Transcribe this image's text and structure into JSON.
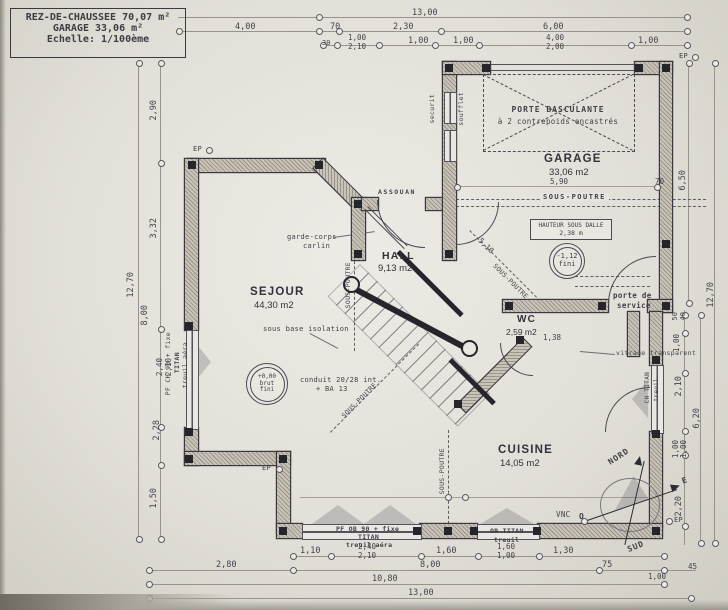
{
  "legend": {
    "title": "REZ-DE-CHAUSSEE  70,07 m²",
    "garage": "GARAGE  33,06 m²",
    "scale": "Echelle: 1/100ème"
  },
  "rooms": {
    "sejour": {
      "name": "SEJOUR",
      "area": "44,30 m2"
    },
    "hall": {
      "name": "HALL",
      "area": "9,13 m2"
    },
    "garage": {
      "name": "GARAGE",
      "area": "33,06 m2"
    },
    "wc": {
      "name": "WC",
      "area": "2,59 m2"
    },
    "cuisine": {
      "name": "CUISINE",
      "area": "14,05 m2"
    }
  },
  "annotations": {
    "porte_basculante_l1": "PORTE BASCULANTE",
    "porte_basculante_l2": "à 2 contrepoids encastrés",
    "sous_poutre": "SOUS-POUTRE",
    "hauteur_dalle_l1": "HAUTEUR SOUS DALLE",
    "hauteur_dalle_l2": "2,38 m",
    "level_low_l1": "-1,12",
    "level_low_l2": "fini",
    "level_zero_l1": "+0,00",
    "level_zero_l2": "brut",
    "level_zero_l3": "+0,12",
    "level_zero_l4": "fini",
    "garde_corps_l1": "garde-corps",
    "garde_corps_l2": "carlin",
    "porte_service_l1": "porte de",
    "porte_service_l2": "service",
    "vitrage": "vitrage transparent",
    "vnc": "VNC",
    "ep": "EP",
    "assouan": "ASSOUAN",
    "securit": "securit",
    "soufflet": "soufflet",
    "isolation": "sous base isolation",
    "conduit_l1": "conduit 20/28 int.",
    "conduit_l2": "+ BA 13"
  },
  "windows": {
    "left_l1": "PF CH 90 + fixe",
    "left_l2": "TITAN",
    "left_l3": "treuil aéra",
    "bottom_l1": "PF OB 90 + fixe",
    "bottom_l2": "TITAN",
    "bottom_l3": "treuil aéra",
    "bottom2_l1": "OB TITAN",
    "bottom2_l2": "treuil",
    "right_l1": "CH TITAN",
    "right_l2": "treuil"
  },
  "compass": {
    "north": "NORD",
    "south": "SUD",
    "east": "E",
    "west": "O"
  },
  "dims": {
    "top": [
      "13,00",
      "4,00",
      "70",
      "2,30",
      "6,00",
      "30",
      "1,00",
      "2,10",
      "1,00",
      "1,00",
      "4,00",
      "2,00",
      "1,00"
    ],
    "bottom": [
      "1,10",
      "2,40",
      "2,10",
      "1,60",
      "1,60",
      "1,00",
      "1,30",
      "2,80",
      "8,00",
      "75",
      "10,80",
      "13,00",
      "1,00",
      "45"
    ],
    "left": [
      "12,70",
      "2,90",
      "3,32",
      "8,00",
      "2,40",
      "2,10",
      "2,28",
      "1,50"
    ],
    "right": [
      "12,70",
      "6,50",
      "50",
      "40",
      "1,00",
      "2,10",
      "6,20",
      "1,00",
      "1,00",
      "2,20"
    ],
    "inner": [
      "5,90",
      "70",
      "5,10",
      "1,38"
    ]
  }
}
